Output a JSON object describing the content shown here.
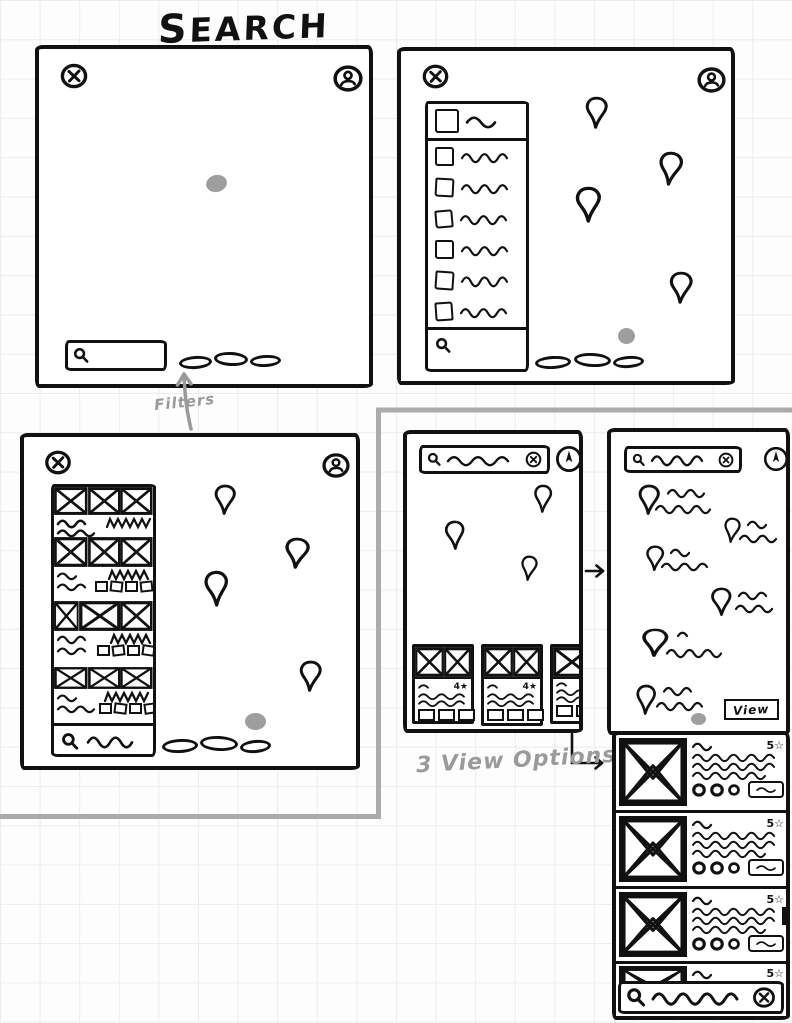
{
  "title": "Search",
  "annotations": {
    "filters": "Filters",
    "view_options": "3 View Options"
  },
  "colors": {
    "ink": "#111111",
    "annotation_gray": "#9a9a9a",
    "location_dot_gray": "#9e9e9e",
    "grid": "#ececec"
  },
  "icons": {
    "close": "circled-x",
    "profile": "person-in-circle",
    "search": "magnifying-glass",
    "clear": "circled-x",
    "locate": "compass-needle-in-circle",
    "checkbox": "empty-square",
    "map_pin": "teardrop-pin",
    "image_placeholder": "crossed-box",
    "location_dot": "gray-ellipse"
  },
  "screen_map_blank": {
    "filter_pills": 3
  },
  "screen_suggestions": {
    "suggestion_rows": 7,
    "map_pins": 4,
    "filter_pills": 3
  },
  "screen_results": {
    "result_blocks": 4,
    "map_pins": 4,
    "filter_pills": 3
  },
  "phone_card_view": {
    "card_rating": "4★",
    "cards": 3,
    "map_pins": 3
  },
  "phone_map_view": {
    "view_button": "View",
    "labeled_pins": 6
  },
  "phone_list_view": {
    "row_rating": "5☆",
    "rows": 4
  }
}
